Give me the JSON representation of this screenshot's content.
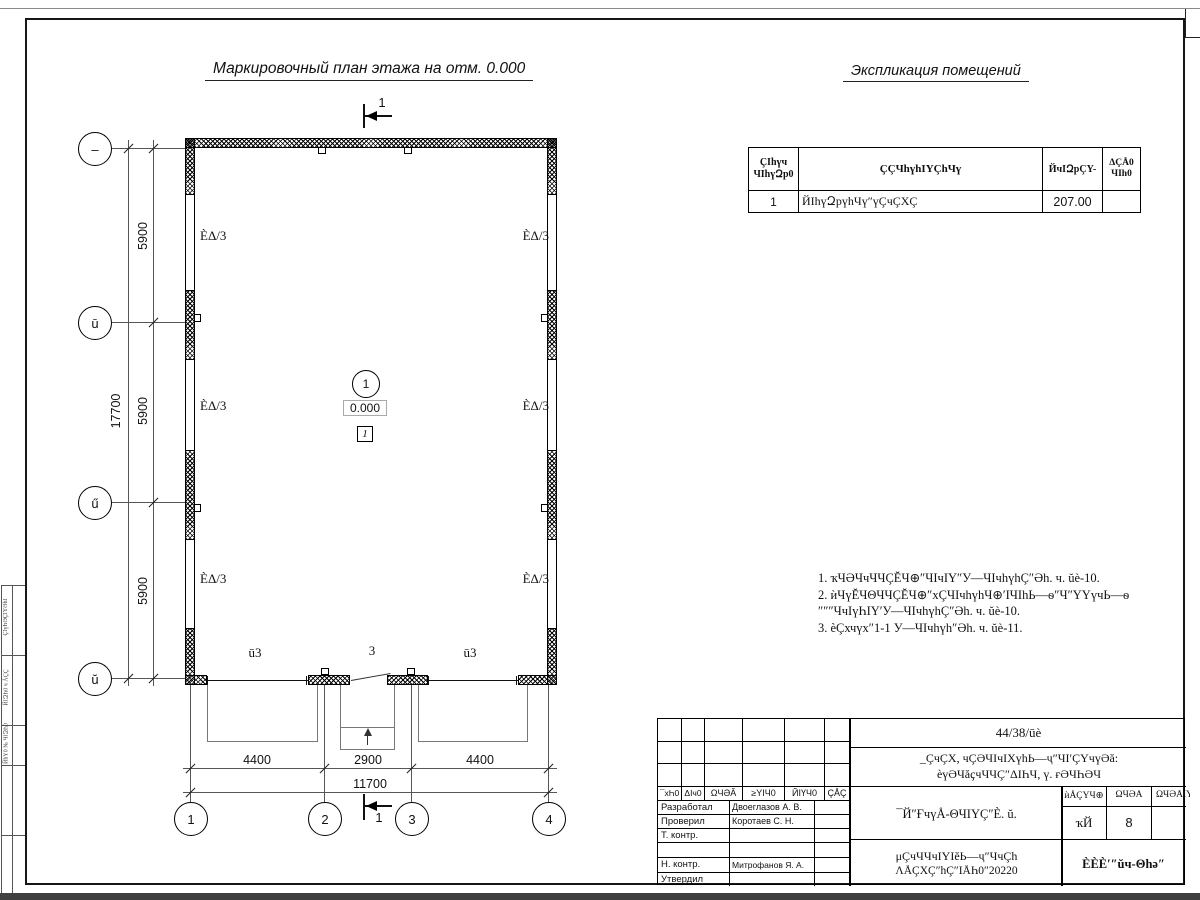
{
  "titles": {
    "plan": "Маркировочный план этажа на отм. 0.000",
    "explication": "Экспликация помещений"
  },
  "explication": {
    "col_num_1": "ҪIhүч",
    "col_num_2": "ЧIhүԶp0",
    "col_name": "ҪÇЧhүhIYÇhЧү",
    "col_area": "ЙчIԶpÇY-",
    "col_note_1": "ΔÇÅ0",
    "col_note_2": "ЧIh0",
    "row": {
      "num": "1",
      "name": "ЙIhүԶpүhЧү″үÇчÇХÇ",
      "area": "207.00",
      "note": ""
    }
  },
  "notes": {
    "l1": "1. ҡЧӘЧчЧЧÇĔЧ⊕″ЧIчIY″У—ЧIчhүhÇ″Әh. ч. ŭè-10.",
    "l2": "2. ѝЧүĔЧΘЧЧÇĔЧ⊕″хÇЧIчhүhЧ⊕′IЧIhЬ—ѳ″Ч″ҮYүчЬ—ѳ",
    "l3": "″″″ЧчIүҺIY′У—ЧIчhүhÇ″Әh. ч. ŭè-10.",
    "l4": "3. ѐÇхчүх″1-1 У—ЧIчhүh″Әh. ч. ŭè-11."
  },
  "axes": {
    "l1": "–",
    "l2": "ū",
    "l3": "ű",
    "l4": "ŭ",
    "b1": "1",
    "b2": "2",
    "b3": "3",
    "b4": "4"
  },
  "dims": {
    "total_v": "17700",
    "seg_v": "5900",
    "b1": "4400",
    "b2": "2900",
    "b3": "4400",
    "total_h": "11700"
  },
  "plan": {
    "panel": "ÈΔ/3",
    "gate": "ū3",
    "door": "3",
    "room_circle": "1",
    "elevation": "0.000",
    "room_box": "1",
    "section": "1"
  },
  "tb": {
    "doc_no": "44/38/ūè",
    "desc1": "_ÇчÇХ, чÇӘЧIчIХүhЬ—ҷ″ЧI′ÇҮчүӘă:",
    "desc2": "ѐүӘЧăҫчЧЧÇ″ΔIҺЧ, ү. ғӘЧҺӘЧ",
    "sheet_title": "¯Й″ҒчүÅ-ΘЧIYÇ″È. ŭ.",
    "stage_h": "ѝÅÇҮЧ⊕",
    "list_h": "ΩЧӘĂ",
    "lists_h": "ΩЧӘÅIY",
    "stage_v": "ҡЙ",
    "list_v": "8",
    "doc_type1": "μÇчЧЧчIYIĕЬ—ҷ″ЧчÇh",
    "doc_type2": "ΛÅÇХÇ″hÇ″IÅҺ0″20220",
    "org": "ÈÈÈ′″ŭч-Θhә″",
    "rev": [
      "¯хҺ0",
      "ΔIч0",
      "ΩЧӘĂ",
      "≥YIЧ0",
      "ЙIҮЧ0",
      "ÇÅÇ"
    ],
    "roles": {
      "r1": "Разработал",
      "r2": "Проверил",
      "r3": "Т. контр.",
      "r4": "Н. контр.",
      "r5": "Утвердил"
    },
    "names": {
      "n1": "Двоеглазов А. В.",
      "n2": "Коротаев С. Н.",
      "n4": "Митрофанов Я. А."
    }
  },
  "strip": {
    "s1": "ҪIүҺӘҪIYӘhI",
    "s2": "ЙIԶҺ0 ч ÅÇÇ",
    "s3": "ЙhY0 № ЧIԶҺ0"
  }
}
